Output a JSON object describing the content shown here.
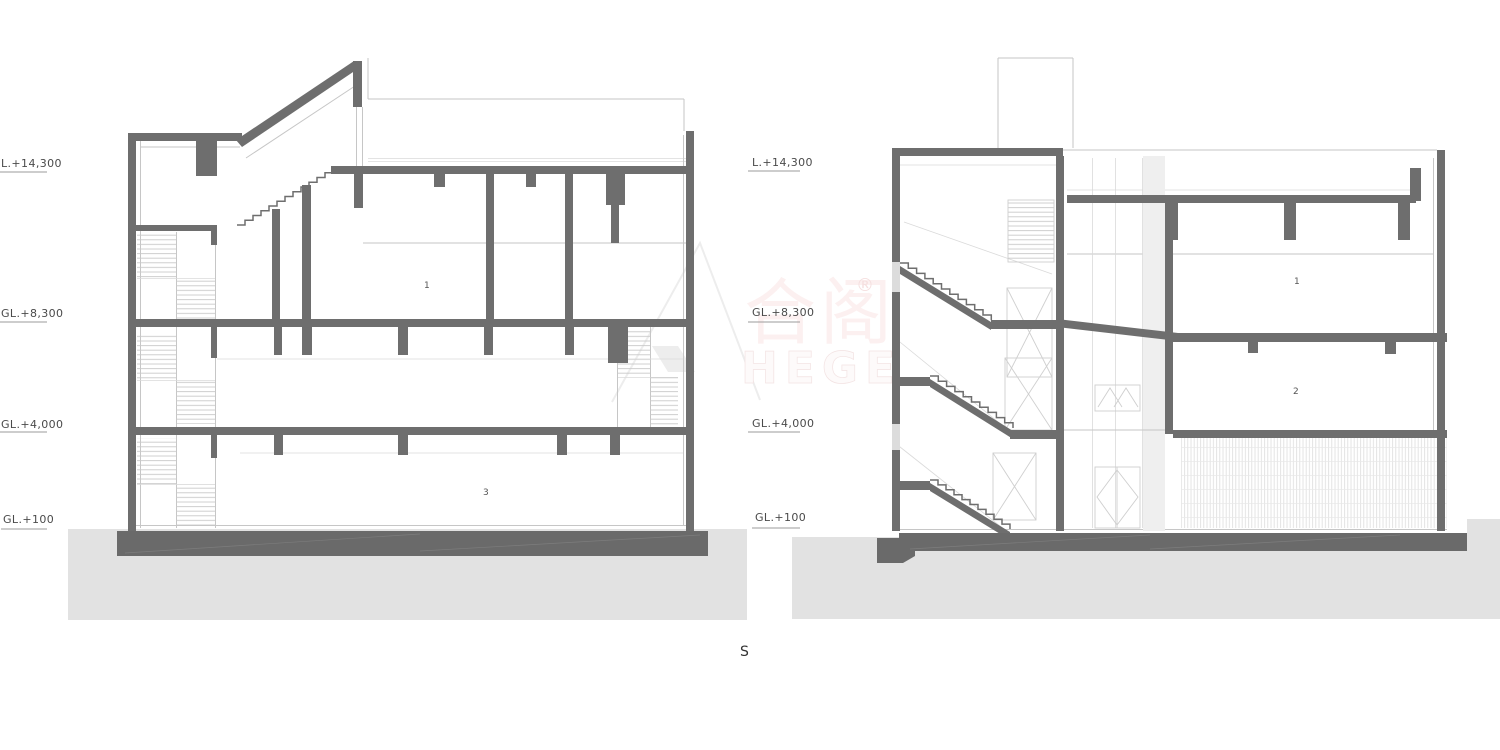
{
  "left_section": {
    "elevations": [
      "L.+14,300",
      "GL.+8,300",
      "GL.+4,000",
      "GL.+100"
    ],
    "rooms": [
      "1",
      "3"
    ]
  },
  "right_section": {
    "elevations": [
      "L.+14,300",
      "GL.+8,300",
      "GL.+4,000",
      "GL.+100"
    ],
    "rooms": [
      "1",
      "2"
    ]
  },
  "section_mark": "S",
  "watermark": {
    "cjk": "合阁",
    "registered": "®",
    "latin": "HEGE"
  },
  "colors": {
    "structure": "#6e6e6e",
    "foundation": "#6a6a6a",
    "soil": "#e2e2e2",
    "thin_line": "#c6c6c6",
    "label": "#4a4a4a",
    "watermark_pink": "#f6e4e4"
  }
}
